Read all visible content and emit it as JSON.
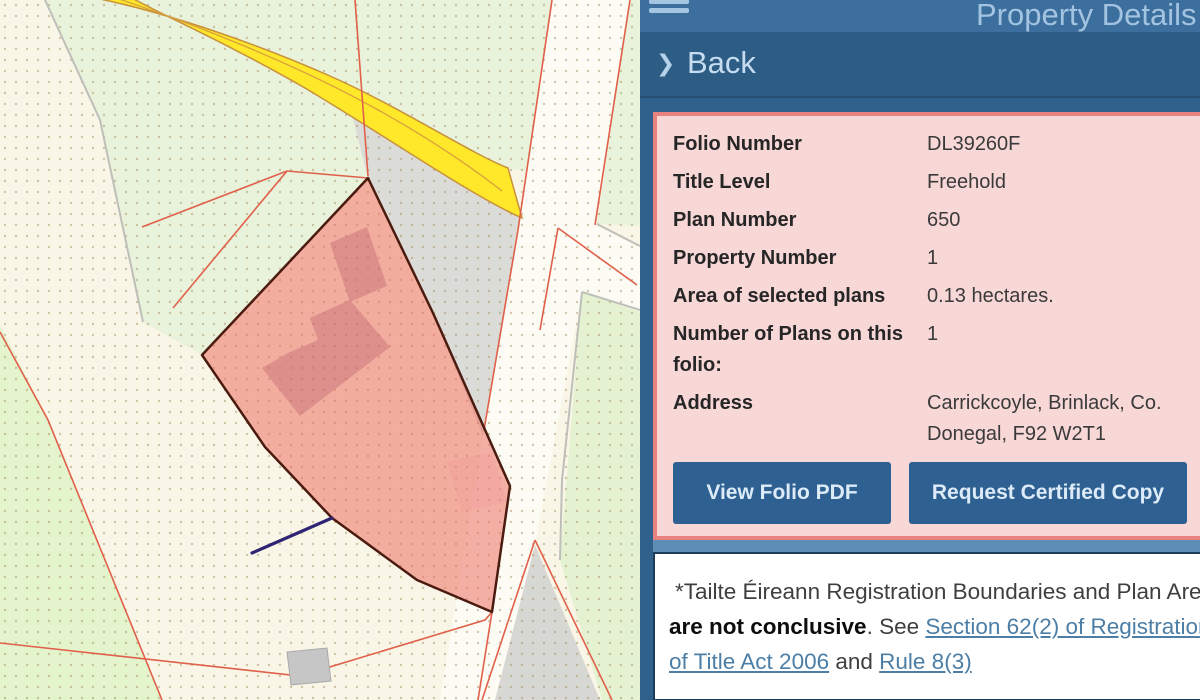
{
  "panel": {
    "title": "Property Details",
    "back": {
      "chevron": "❯",
      "label": "Back"
    },
    "details": {
      "rows": [
        {
          "label": "Folio Number",
          "value": "DL39260F"
        },
        {
          "label": "Title Level",
          "value": "Freehold"
        },
        {
          "label": "Plan Number",
          "value": "650"
        },
        {
          "label": "Property Number",
          "value": "1"
        },
        {
          "label": "Area of selected plans",
          "value": "0.13 hectares."
        },
        {
          "label": "Number of Plans on this folio:",
          "value": "1"
        },
        {
          "label": "Address",
          "value": "Carrickcoyle, Brinlack, Co. Donegal, F92 W2T1"
        }
      ],
      "buttons": [
        {
          "label": "View Folio PDF"
        },
        {
          "label": "Request Certified Copy"
        }
      ]
    },
    "disclaimer": {
      "text1": "*Tailte Éireann Registration Boundaries and Plan Area ",
      "bold1": "are not conclusive",
      "text2": ". See ",
      "link1": "Section 62(2) of Registration of Title Act 2006",
      "text3": " and ",
      "link2": "Rule 8(3)"
    }
  },
  "map": {
    "colors": {
      "selected_parcel": "#f2a09a",
      "parcel_outline": "#4b1b10",
      "road_yellow": "#ffe82a",
      "boundary_orange": "#e0604a",
      "panel_blue": "#2e5e88",
      "details_pink": "#f8d7d7",
      "details_border": "#e8827e",
      "button_blue": "#2e6092",
      "link_blue": "#4c7ea6"
    }
  }
}
